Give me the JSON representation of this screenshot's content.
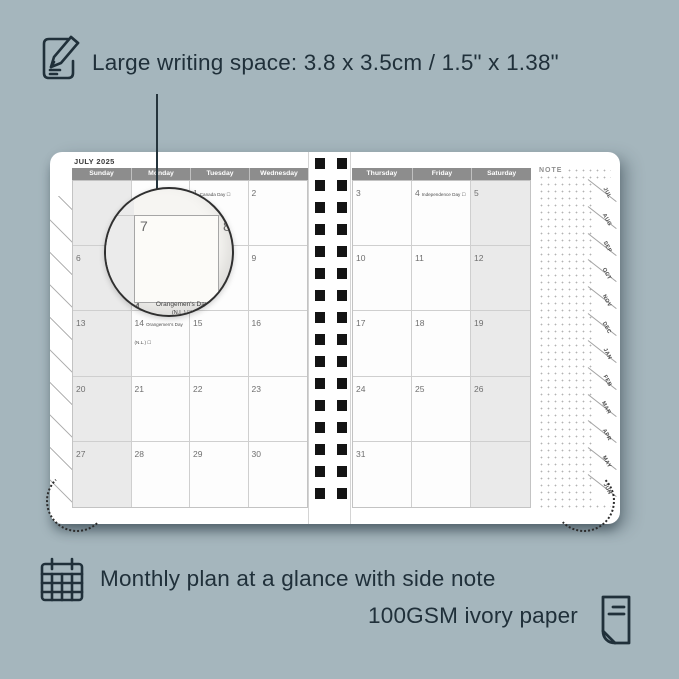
{
  "colors": {
    "background": "#a5b6bd",
    "ink": "#20303a",
    "header_bar": "#8d8d8d",
    "weekend_shade": "#eaeaea",
    "spiral": "#141414"
  },
  "top_caption": "Large writing space: 3.8 x 3.5cm / 1.5\" x 1.38\"",
  "bottom_caption_line1": "Monthly plan at a glance with side note",
  "bottom_caption_line2": "100GSM ivory paper",
  "planner": {
    "month_title": "JULY 2025",
    "note_label": "NOTE",
    "left_headers": [
      "Sunday",
      "Monday",
      "Tuesday",
      "Wednesday"
    ],
    "right_headers": [
      "Thursday",
      "Friday",
      "Saturday"
    ],
    "left_cells": [
      {
        "day": "",
        "holiday": ""
      },
      {
        "day": "",
        "holiday": ""
      },
      {
        "day": "1",
        "holiday": "Canada Day ☐"
      },
      {
        "day": "2",
        "holiday": ""
      },
      {
        "day": "6",
        "holiday": ""
      },
      {
        "day": "7",
        "holiday": ""
      },
      {
        "day": "8",
        "holiday": ""
      },
      {
        "day": "9",
        "holiday": ""
      },
      {
        "day": "13",
        "holiday": ""
      },
      {
        "day": "14",
        "holiday": "Orangemen's Day (N.L.) ☐"
      },
      {
        "day": "15",
        "holiday": ""
      },
      {
        "day": "16",
        "holiday": ""
      },
      {
        "day": "20",
        "holiday": ""
      },
      {
        "day": "21",
        "holiday": ""
      },
      {
        "day": "22",
        "holiday": ""
      },
      {
        "day": "23",
        "holiday": ""
      },
      {
        "day": "27",
        "holiday": ""
      },
      {
        "day": "28",
        "holiday": ""
      },
      {
        "day": "29",
        "holiday": ""
      },
      {
        "day": "30",
        "holiday": ""
      }
    ],
    "right_cells": [
      {
        "day": "3",
        "holiday": ""
      },
      {
        "day": "4",
        "holiday": "Independence Day ☐"
      },
      {
        "day": "5",
        "holiday": ""
      },
      {
        "day": "10",
        "holiday": ""
      },
      {
        "day": "11",
        "holiday": ""
      },
      {
        "day": "12",
        "holiday": ""
      },
      {
        "day": "17",
        "holiday": ""
      },
      {
        "day": "18",
        "holiday": ""
      },
      {
        "day": "19",
        "holiday": ""
      },
      {
        "day": "24",
        "holiday": ""
      },
      {
        "day": "25",
        "holiday": ""
      },
      {
        "day": "26",
        "holiday": ""
      },
      {
        "day": "31",
        "holiday": ""
      },
      {
        "day": "",
        "holiday": ""
      },
      {
        "day": "",
        "holiday": ""
      }
    ],
    "tabs": [
      "JUL",
      "AUG",
      "SEP",
      "OCT",
      "NOV",
      "DEC",
      "JAN",
      "FEB",
      "MAR",
      "APR",
      "MAY",
      "JUN"
    ],
    "magnifier": {
      "day_main": "7",
      "day_next": "8",
      "day_bottom": "14",
      "holiday_line1": "Orangemen's Day",
      "holiday_line2": "(N.L.) ☐"
    }
  }
}
